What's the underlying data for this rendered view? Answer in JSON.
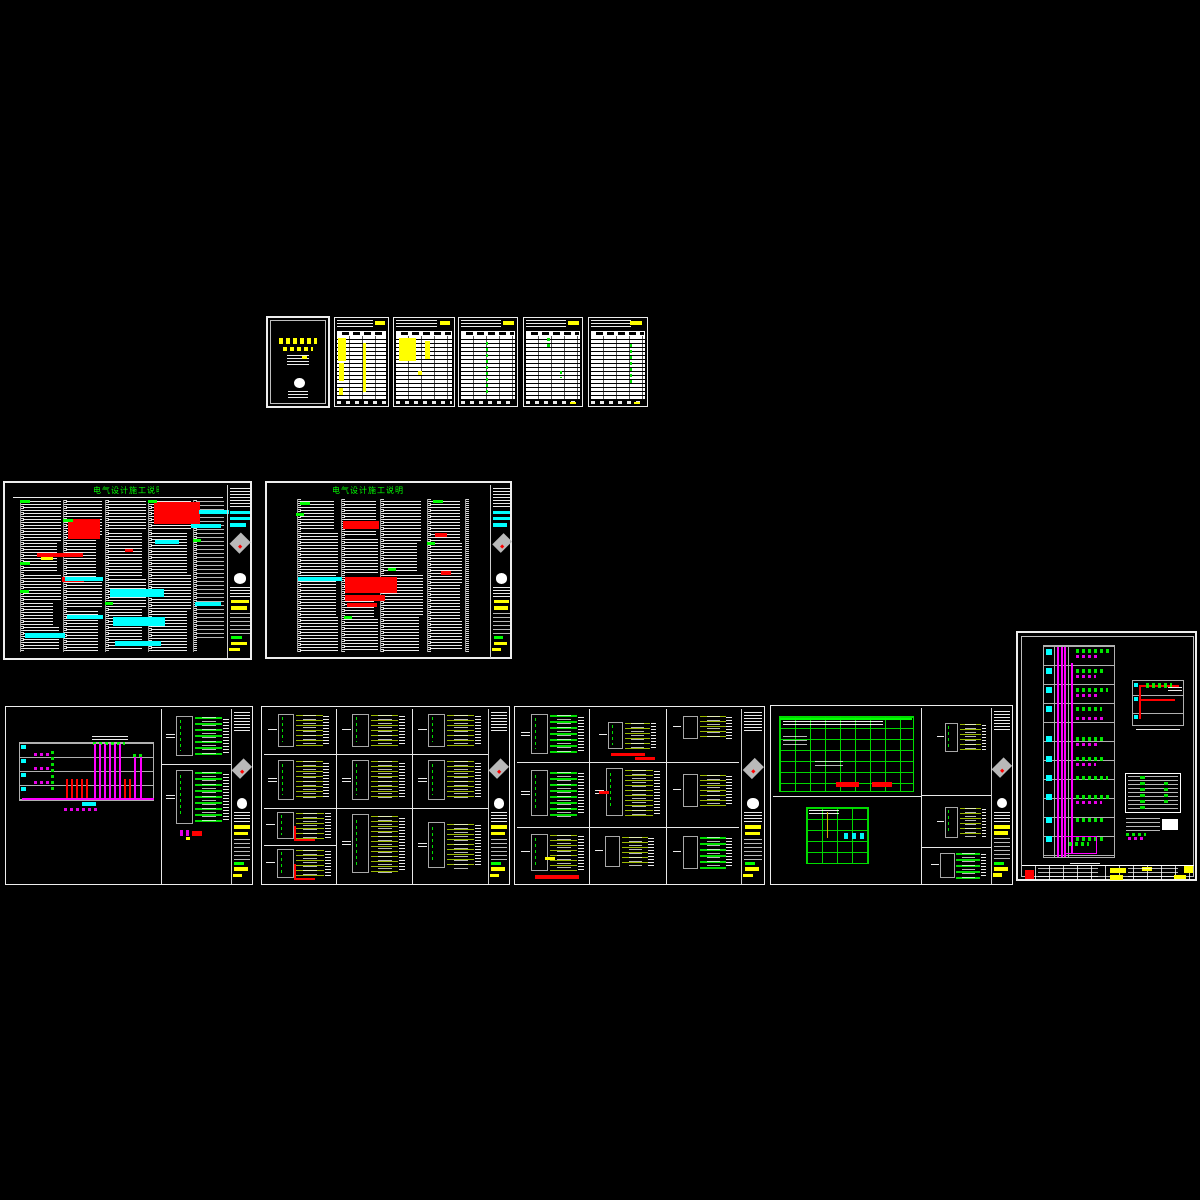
{
  "canvas": {
    "background": "#000000",
    "content_label": "CAD model space - electrical construction drawing set"
  },
  "palette": {
    "background": "#000000",
    "sheet_border": "#ededed",
    "text_white": "#ffffff",
    "highlight_yellow": "#ffff00",
    "accent_red": "#ff0000",
    "accent_cyan": "#00ffff",
    "accent_magenta": "#ff00ff",
    "accent_green": "#00ff00",
    "circuit_olive": "#9ab800",
    "frame_grey": "#a8a8a8",
    "paper_white": "#ffffff"
  },
  "sheets": {
    "cover": {
      "label": "cover sheet"
    },
    "index_tables": {
      "label": "drawing index / equipment-material tables",
      "count": 5
    },
    "spec_1": {
      "title": "电气设计施工说明(一)"
    },
    "spec_2": {
      "title": "电气设计施工说明(二)"
    },
    "riser": {
      "label": "power riser diagram + panel diagrams"
    },
    "panels_a": {
      "label": "distribution panel schematics",
      "count": 10
    },
    "panels_b": {
      "label": "distribution panel schematics",
      "count": 9
    },
    "main_lv": {
      "label": "low-voltage main one-line diagram"
    },
    "elv_riser": {
      "label": "ELV riser diagram"
    }
  }
}
